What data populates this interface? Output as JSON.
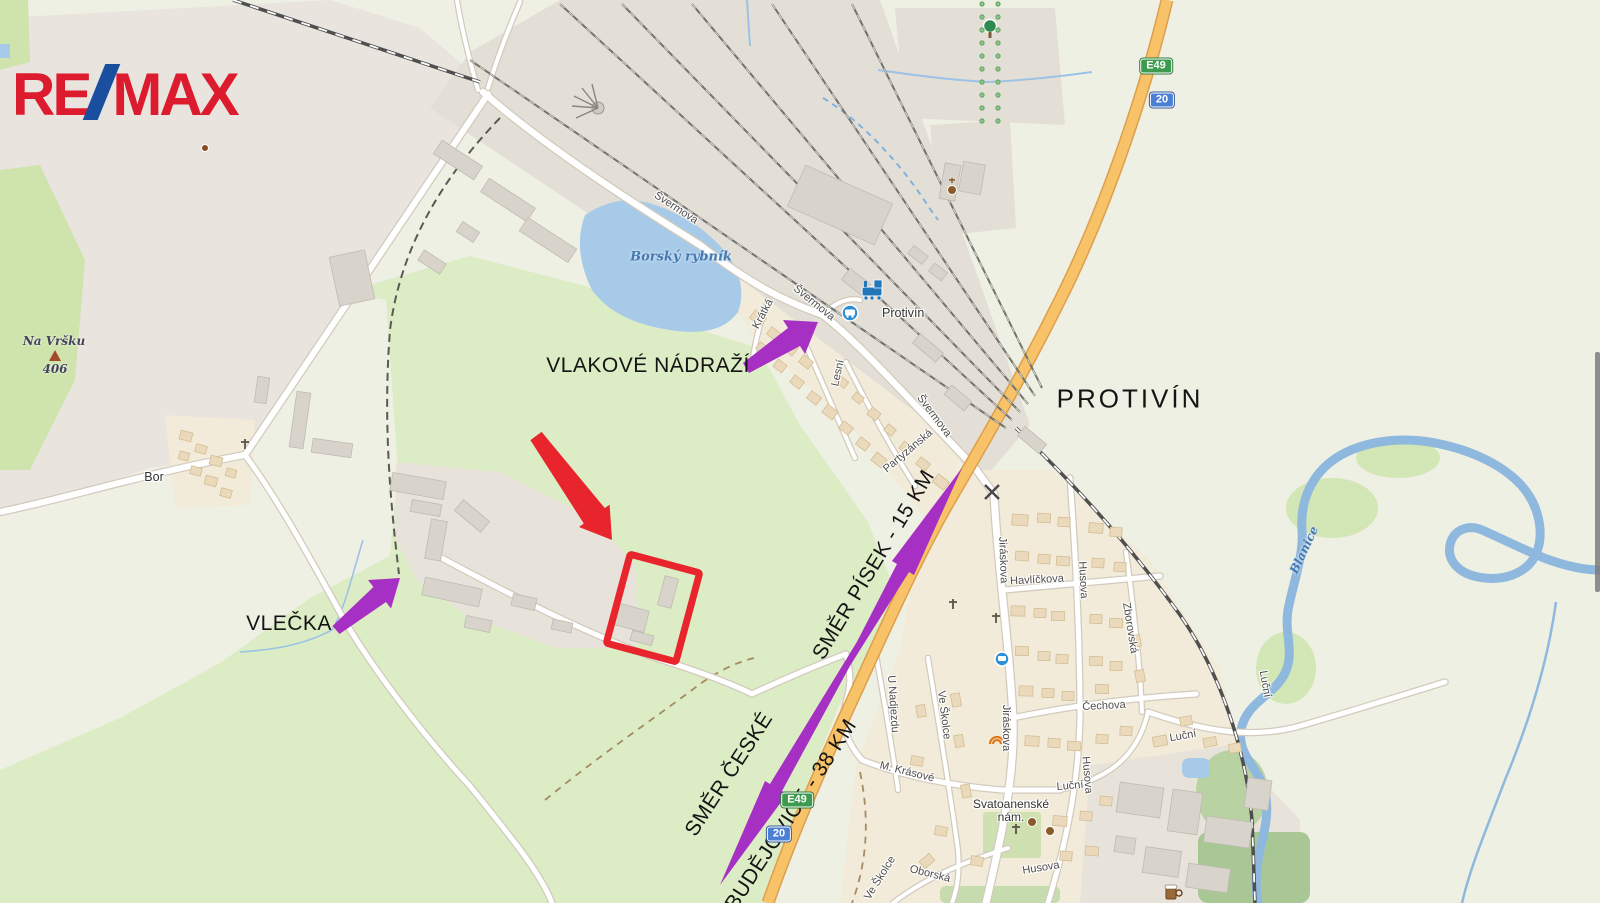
{
  "logo": {
    "part1": "RE",
    "separator": "/",
    "part2": "MAX"
  },
  "annotations": {
    "train_station_label": "VLAKOVÉ NÁDRAŽÍ",
    "siding_label": "VLEČKA",
    "direction_pisek_label": "SMĚR PÍSEK - 15 KM",
    "direction_budejovice_line1": "SMĚR ČESKÉ",
    "direction_budejovice_line2": "BUDĚJOVICE - 38 KM",
    "city_label": "PROTIVÍN"
  },
  "places": {
    "hamlet": "Bor",
    "hill_name": "Na Vršku",
    "hill_elevation": "406",
    "lake_name": "Borský rybník",
    "river_name": "Blanice",
    "station_name": "Protivín",
    "square_line1": "Svatoanenské",
    "square_line2": "nám."
  },
  "streets": {
    "svermova": "Švermova",
    "kratka": "Krátká",
    "lesni": "Lesní",
    "partyzanska": "Partyzánská",
    "jiraskova": "Jiráskova",
    "havlickova": "Havlíčkova",
    "husova": "Husova",
    "zborovska": "Zborovská",
    "cechova": "Čechova",
    "lucni": "Luční",
    "m_krasove": "M. Krásové",
    "u_nadjezdu": "U Nadjezdu",
    "ve_skolce": "Ve Školce",
    "oborska": "Oborská"
  },
  "shields": {
    "european_route": "E49",
    "national_road": "20"
  },
  "colors": {
    "remax_red": "#dc1c2e",
    "remax_blue": "#1a4fa0",
    "arrow_purple": "#a62fc4",
    "highlight_red": "#e8242c",
    "highway_orange": "#f8c268",
    "highway_casing": "#dd9f4b",
    "water_blue": "#a6cae8",
    "river_blue": "#8fb8de",
    "shield_green": "#3d9b4f",
    "shield_blue": "#4a7fd4",
    "meadow_green": "#dcecc4",
    "town_tan": "#f3ebd9",
    "industrial_gray": "#e9e4de"
  }
}
